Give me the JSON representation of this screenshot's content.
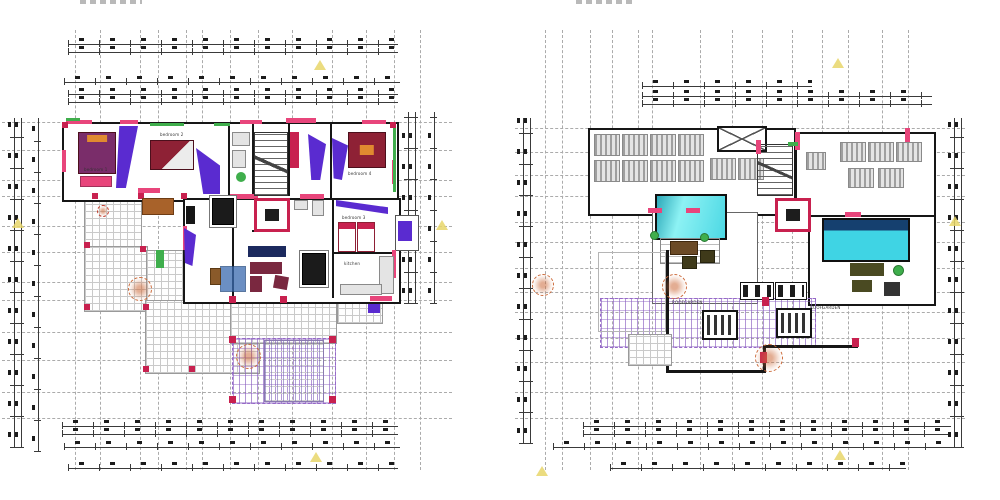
{
  "colors": {
    "accent_pink": "#e8457b",
    "accent_crimson": "#c8214f",
    "accent_green": "#3fae4c",
    "accent_purple": "#5a2bd0",
    "bed_red": "#8e2135",
    "pillow_orange": "#e08a30",
    "pergola_purple": "#9668c8",
    "tree_orange": "#cc6a3a",
    "marker_yellow": "#e8d66a"
  },
  "left_plan": {
    "labels": {
      "bedroom1": "bedroom 1",
      "bedroom2": "bedroom 2",
      "bedroom3": "bedroom 3",
      "bedroom4": "bedroom 4",
      "kitchen": "kitchen"
    }
  },
  "right_plan": {
    "labels": {
      "roofgarden_left": "ROOFGARDEN",
      "roofgarden_right": "ROOFGARDEN"
    }
  }
}
